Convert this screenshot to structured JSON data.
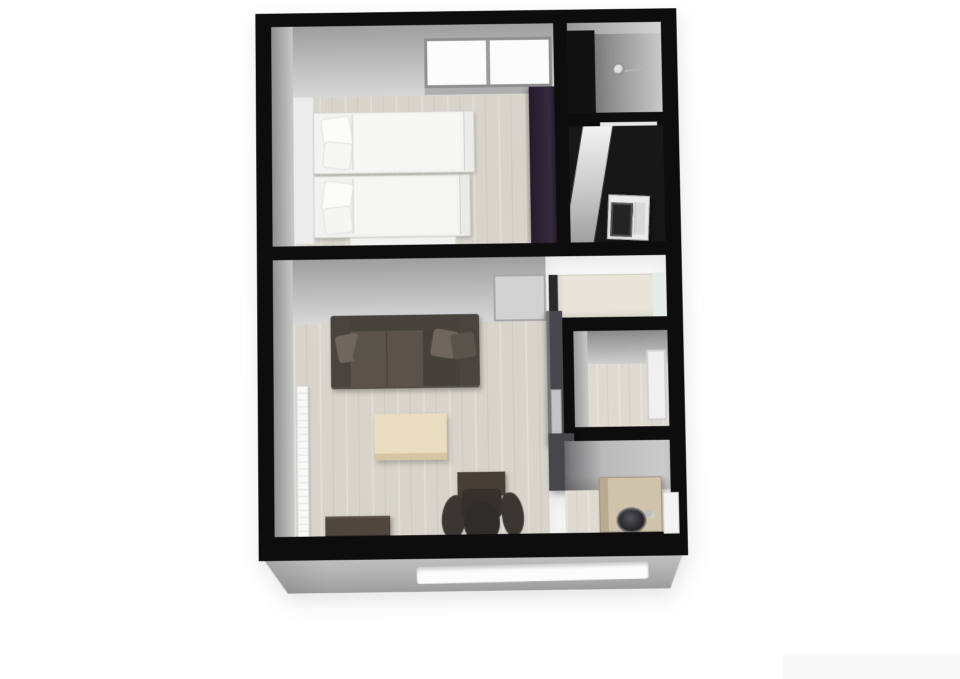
{
  "scene": {
    "type": "3d-floor-plan-render",
    "background_color": "#ffffff",
    "visible_text": "",
    "watermark_panel_color": "#f8f8f8"
  },
  "palette": {
    "wall": "#0d0d0d",
    "wall_face_light": "#d8d8d8",
    "wall_face_dark": "#8f8f8f",
    "floor_wood": "#d8d4cc",
    "floor_dark": "#171717",
    "plinth": "#b5b5b5",
    "bed": "#f3f3f1",
    "wardrobe": "#2a2230",
    "sofa": "#554e47",
    "sofa_pillow": "#6f675f",
    "coffee_table": "#e9dcc0",
    "desk": "#463e37",
    "chair": "#33302c",
    "cabinet": "#4f463e",
    "kitchen_counter": "#48484c",
    "refrigerator": "#e9e4d9",
    "washer": "#ebebeb",
    "vanity": "#d0c3ac",
    "radiator": "#f8f8f8",
    "window_glow": "#fcfcfc"
  },
  "rooms": [
    {
      "id": "bedroom",
      "label": "Bedroom"
    },
    {
      "id": "shower-room",
      "label": "Shower room"
    },
    {
      "id": "laundry",
      "label": "Laundry / WC"
    },
    {
      "id": "living-room",
      "label": "Living room with kitchenette"
    },
    {
      "id": "hallway",
      "label": "Hallway closet"
    },
    {
      "id": "entry",
      "label": "Entry area"
    }
  ],
  "fixtures": {
    "bedroom_window": {
      "label": "Bedroom window"
    },
    "bed1": {
      "label": "Single bed"
    },
    "bed2": {
      "label": "Single bed"
    },
    "wardrobe": {
      "label": "Wardrobe"
    },
    "bench": {
      "label": "Bedside bench"
    },
    "shower_head": {
      "label": "Shower head"
    },
    "washing_machine": {
      "label": "Washing machine"
    },
    "bedroom_door": {
      "label": "Bedroom door"
    },
    "sofa": {
      "label": "Three-seat sofa"
    },
    "coffee_table": {
      "label": "Coffee table"
    },
    "radiator": {
      "label": "Radiator"
    },
    "desk": {
      "label": "Desk"
    },
    "office_chair": {
      "label": "Office chair"
    },
    "cabinet": {
      "label": "Low cabinet"
    },
    "kitchen_counter": {
      "label": "Kitchen counter"
    },
    "kitchen_sink": {
      "label": "Kitchen sink"
    },
    "refrigerator": {
      "label": "Refrigerator cabinet"
    },
    "hallway_door": {
      "label": "Hallway door"
    },
    "entry_door": {
      "label": "Entry door"
    },
    "vanity": {
      "label": "Vanity with basin"
    },
    "basin": {
      "label": "Round basin"
    },
    "plinth_window": {
      "label": "Front wall window"
    }
  }
}
